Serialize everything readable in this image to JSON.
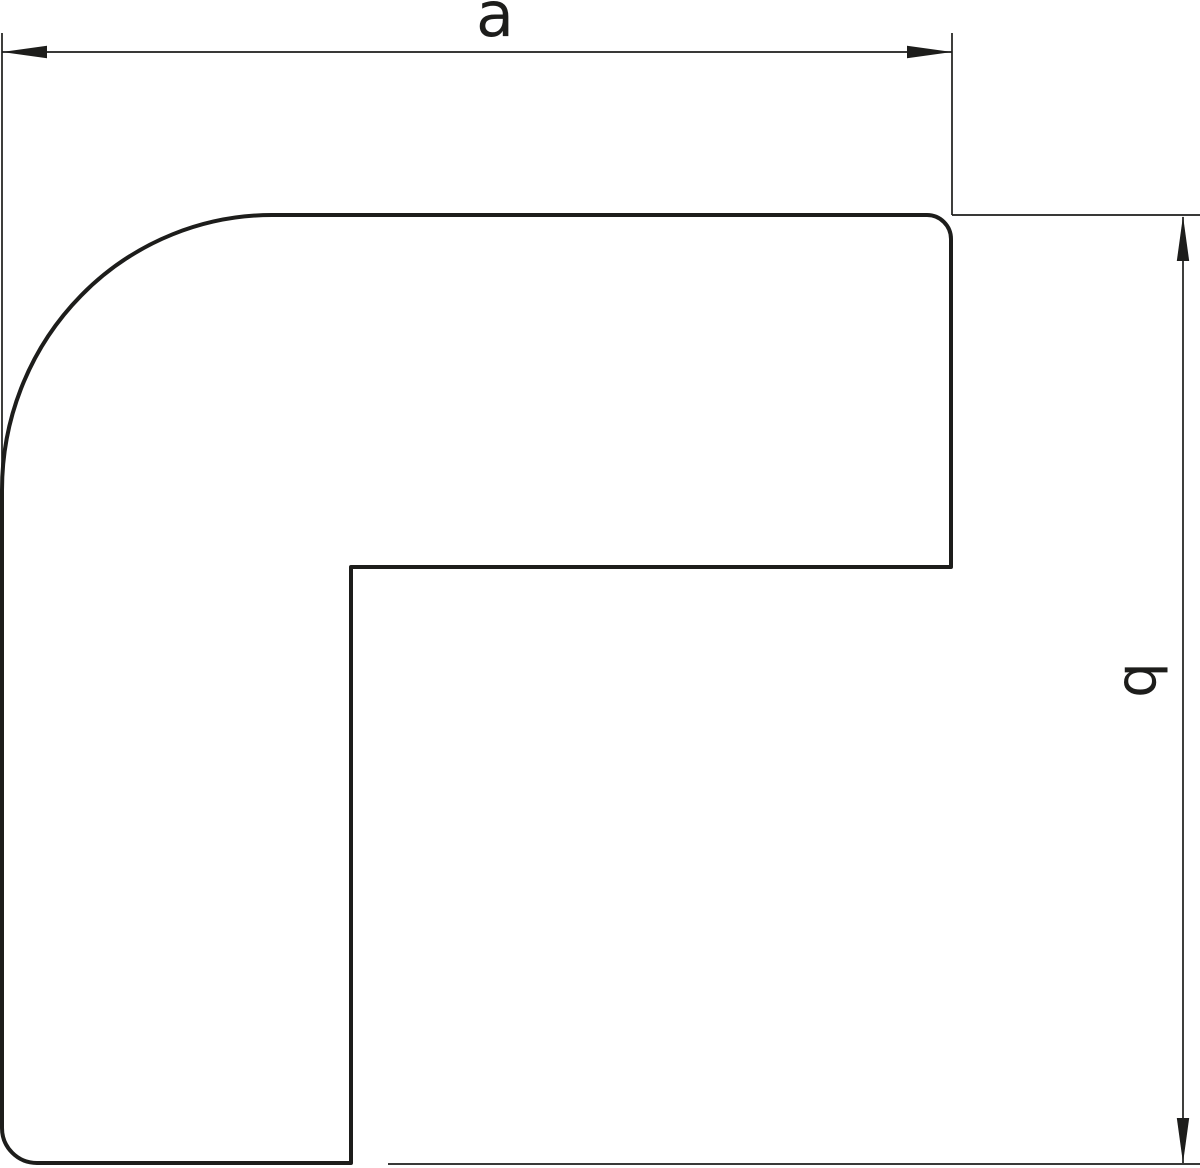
{
  "drawing": {
    "description": "Technical dimension drawing of a flat L-shaped elbow profile with width dimension a and height dimension b",
    "background_color": "#ffffff",
    "line_color": "#1d1d1b",
    "canvas": {
      "width": 1200,
      "height": 1168,
      "viewbox": "0 0 1200 1168"
    }
  },
  "shape": {
    "name": "flat-elbow-profile",
    "fill_color": "#ffffff",
    "outline_width": 4,
    "path": "M 272 215 L 927 215 A 24 24 0 0 1 951 239 L 951 567 L 351 567 L 351 1163 L 37 1163 A 35 35 0 0 1 2 1128 L 2 490 A 270 275 0 0 1 272 215 Z"
  },
  "dimensions": {
    "line_width": 1.7,
    "a": {
      "label": "a",
      "orientation": "horizontal",
      "dimension_line": "M 2 52 L 952 52",
      "extension_line_start": "M 2 33 L 2 500",
      "extension_line_end": "M 952 33 L 952 215",
      "arrowhead_start": "M 2 52 L 47 45.8 L 47 58.2 Z",
      "arrowhead_end": "M 952 52 L 907 45.8 L 907 58.2 Z",
      "label_x": 495,
      "label_y": 36,
      "label_font_size": 62
    },
    "b": {
      "label": "b",
      "orientation": "vertical",
      "dimension_line": "M 1183 217 L 1183 1163",
      "extension_line_start": "M 952 215 L 1200 215",
      "extension_line_end": "M 388 1164 L 1200 1164",
      "arrowhead_start": "M 1183 216 L 1176.8 261 L 1189.2 261 Z",
      "arrowhead_end": "M 1183 1163 L 1176.8 1118 L 1189.2 1118 Z",
      "label_transform": "translate(1125 680) rotate(90)",
      "label_font_size": 56
    }
  }
}
